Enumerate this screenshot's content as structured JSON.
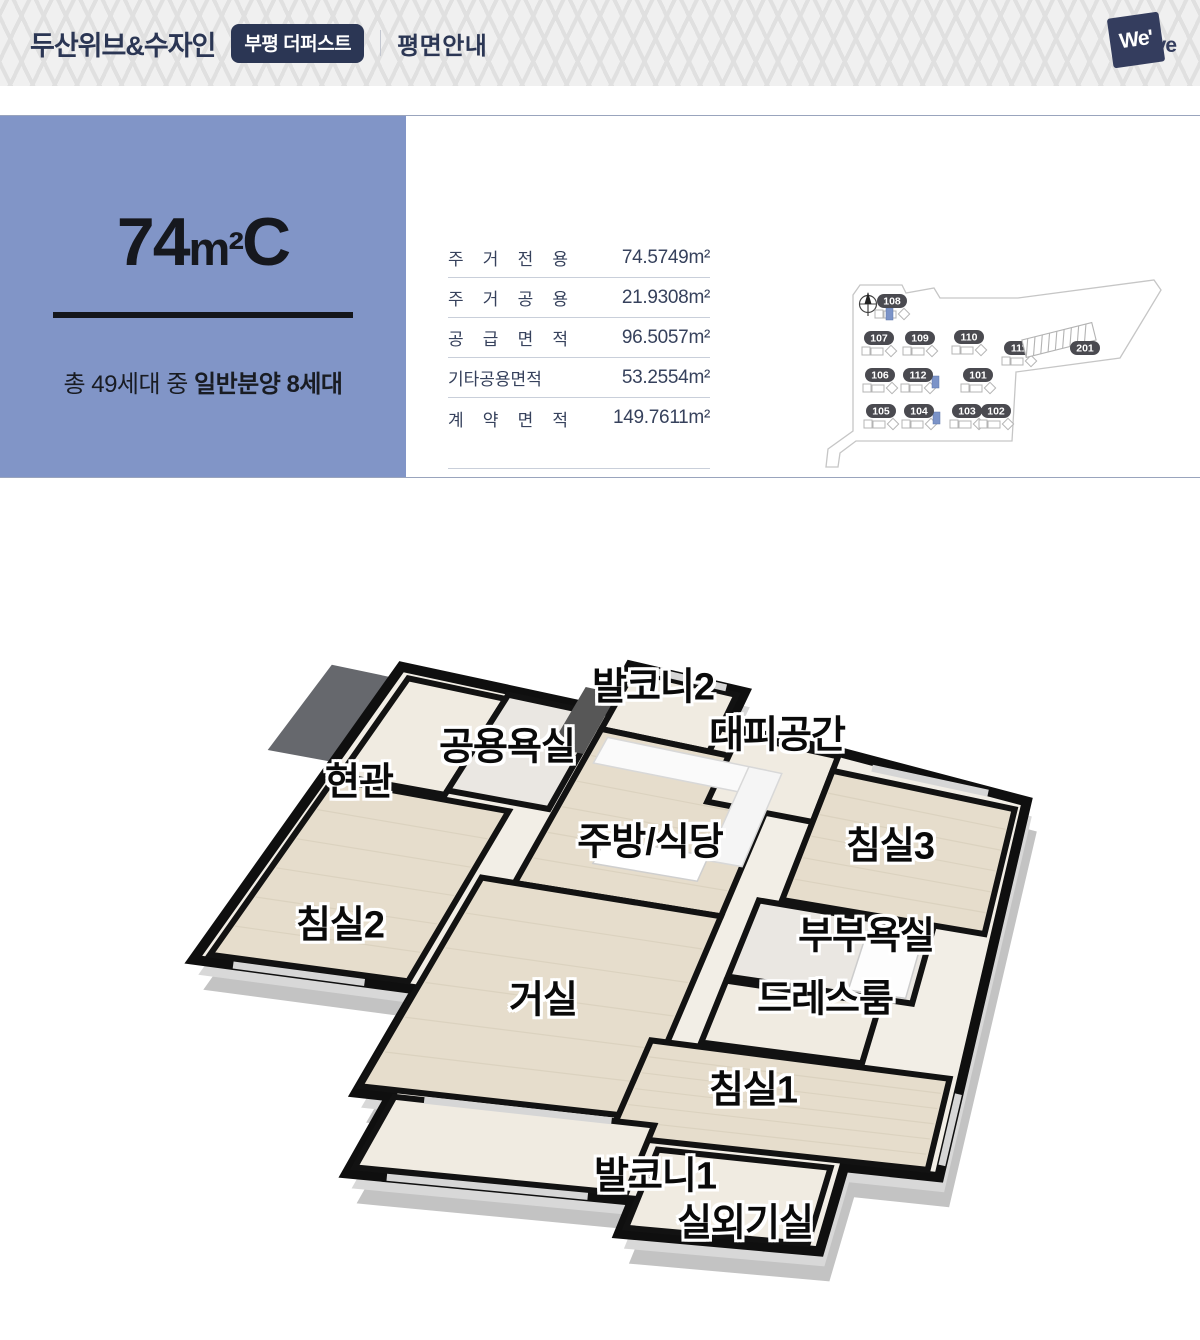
{
  "header": {
    "brand": "두산위브&수자인",
    "badge": "부평 더퍼스트",
    "page_title": "평면안내",
    "logo": {
      "boxed": "We'",
      "tail": "ve"
    }
  },
  "unit": {
    "size": "74",
    "area_unit": "m²",
    "type": "C",
    "note_prefix": "총 49세대 중 ",
    "note_bold": "일반분양 8세대"
  },
  "area_table": {
    "rows": [
      {
        "label": "주 거 전 용",
        "value": "74.5749m²"
      },
      {
        "label": "주 거 공 용",
        "value": "21.9308m²"
      },
      {
        "label": "공 급 면 적",
        "value": "96.5057m²"
      },
      {
        "label": "기타공용면적",
        "value": "53.2554m²"
      },
      {
        "label": "계 약 면 적",
        "value": "149.7611m²"
      }
    ]
  },
  "site_map": {
    "highlight_color": "#7b93c8",
    "buildings": [
      {
        "id": "108",
        "x": 892,
        "y": 302,
        "highlight": true,
        "hx": -6,
        "hy": 7
      },
      {
        "id": "107",
        "x": 879,
        "y": 339
      },
      {
        "id": "109",
        "x": 920,
        "y": 339
      },
      {
        "id": "110",
        "x": 969,
        "y": 338
      },
      {
        "id": "111",
        "x": 1019,
        "y": 349
      },
      {
        "id": "201",
        "x": 1085,
        "y": 349
      },
      {
        "id": "106",
        "x": 880,
        "y": 376
      },
      {
        "id": "112",
        "x": 918,
        "y": 376,
        "highlight": true,
        "hx": 14,
        "hy": 1
      },
      {
        "id": "101",
        "x": 978,
        "y": 376
      },
      {
        "id": "105",
        "x": 881,
        "y": 412
      },
      {
        "id": "104",
        "x": 919,
        "y": 412,
        "highlight": true,
        "hx": 14,
        "hy": 1
      },
      {
        "id": "103",
        "x": 967,
        "y": 412
      },
      {
        "id": "102",
        "x": 996,
        "y": 412
      }
    ]
  },
  "floor_plan": {
    "rooms": [
      {
        "key": "balcony2",
        "label": "발코니2",
        "x": 653,
        "y": 683
      },
      {
        "key": "refuge",
        "label": "대피공간",
        "x": 777,
        "y": 731
      },
      {
        "key": "shared-bath",
        "label": "공용욕실",
        "x": 507,
        "y": 743
      },
      {
        "key": "entrance",
        "label": "현관",
        "x": 359,
        "y": 778
      },
      {
        "key": "kitchen-dining",
        "label": "주방/식당",
        "x": 650,
        "y": 838
      },
      {
        "key": "bedroom3",
        "label": "침실3",
        "x": 890,
        "y": 842
      },
      {
        "key": "bedroom2",
        "label": "침실2",
        "x": 340,
        "y": 921
      },
      {
        "key": "master-bath",
        "label": "부부욕실",
        "x": 866,
        "y": 932
      },
      {
        "key": "dress-room",
        "label": "드레스룸",
        "x": 825,
        "y": 995
      },
      {
        "key": "living",
        "label": "거실",
        "x": 543,
        "y": 996
      },
      {
        "key": "bedroom1",
        "label": "침실1",
        "x": 753,
        "y": 1086
      },
      {
        "key": "balcony1",
        "label": "발코니1",
        "x": 655,
        "y": 1172
      },
      {
        "key": "outdoor-unit",
        "label": "실외기실",
        "x": 745,
        "y": 1219
      }
    ]
  }
}
